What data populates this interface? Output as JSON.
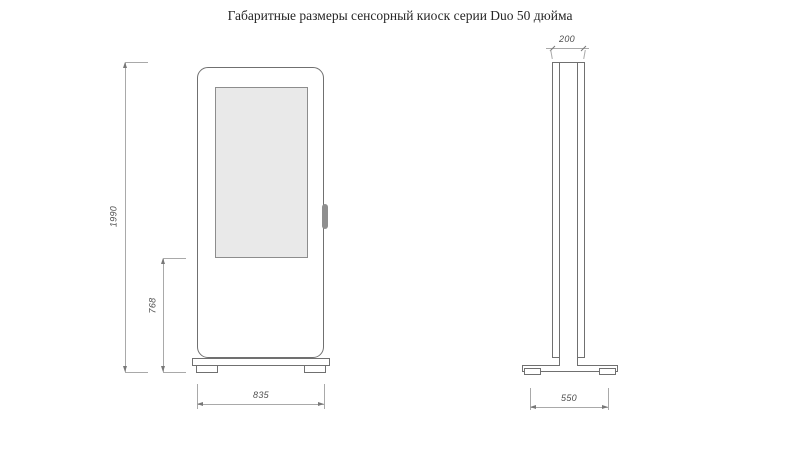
{
  "title": "Габаритные размеры сенсорный киоск серии Duo 50 дюйма",
  "drawing": {
    "front_view": {
      "dims": {
        "height": "1990",
        "screen_bottom_to_floor": "768",
        "width": "835"
      }
    },
    "side_view": {
      "dims": {
        "depth": "200",
        "base_depth": "550"
      }
    },
    "colors": {
      "object_line": "#707070",
      "dimension_line": "#a9a9a9",
      "screen_fill": "#e9e9e9",
      "handle_fill": "#8f8f8f",
      "dim_text": "#4f4f4f",
      "title_text": "#262626"
    }
  }
}
